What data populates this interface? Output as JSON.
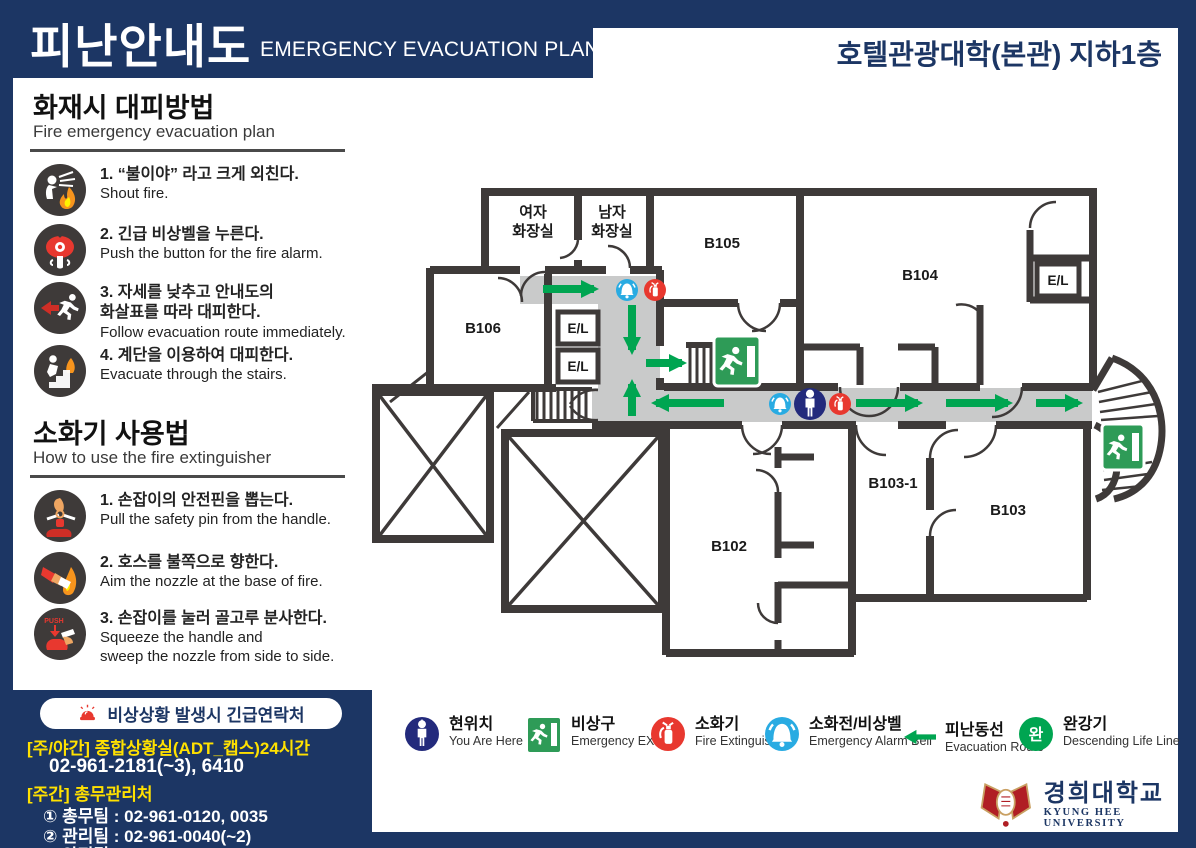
{
  "header": {
    "title_ko": "피난안내도",
    "title_en": "EMERGENCY EVACUATION PLAN",
    "building": "호텔관광대학(본관) 지하1층"
  },
  "sidebar": {
    "fire": {
      "title": "화재시 대피방법",
      "subtitle": "Fire emergency evacuation plan",
      "items": [
        {
          "icon": "shout-fire-icon",
          "ko": "1. “불이야” 라고 크게 외친다.",
          "en": "Shout fire."
        },
        {
          "icon": "alarm-button-icon",
          "ko": "2. 긴급 비상벨을 누른다.",
          "en": "Push the button for the fire alarm."
        },
        {
          "icon": "follow-route-icon",
          "ko": "3. 자세를 낮추고 안내도의\n화살표를 따라 대피한다.",
          "en": "Follow evacuation route immediately."
        },
        {
          "icon": "use-stairs-icon",
          "ko": "4. 계단을 이용하여 대피한다.",
          "en": "Evacuate through the stairs."
        }
      ]
    },
    "ext": {
      "title": "소화기 사용법",
      "subtitle": "How to use the fire extinguisher",
      "items": [
        {
          "icon": "pull-pin-icon",
          "ko": "1. 손잡이의 안전핀을 뽑는다.",
          "en": "Pull the safety pin from the handle."
        },
        {
          "icon": "aim-nozzle-icon",
          "ko": "2. 호스를 불쪽으로 향한다.",
          "en": "Aim the nozzle at the base of fire."
        },
        {
          "icon": "squeeze-icon",
          "ko": "3. 손잡이를 눌러 골고루 분사한다.",
          "en": "Squeeze the handle and\nsweep the nozzle from side to side."
        }
      ]
    }
  },
  "contact": {
    "icon": "siren-icon",
    "title": "비상상황 발생시 긴급연락처",
    "lines": [
      {
        "text": "[주/야간] 종합상황실(ADT_캡스)24시간",
        "style": "yellow"
      },
      {
        "text": "02-961-2181(~3), 6410",
        "style": "phone"
      },
      {
        "text": "[주간] 총무관리처",
        "style": "yellow"
      },
      {
        "text": "① 총무팀 : 02-961-0120, 0035",
        "style": "white"
      },
      {
        "text": "② 관리팀 : 02-961-0040(~2)",
        "style": "white"
      },
      {
        "text": "③ 안전팀 : 02-961-0119",
        "style": "white"
      }
    ]
  },
  "floorplan": {
    "labels": {
      "women_1": "여자",
      "women_2": "화장실",
      "men_1": "남자",
      "men_2": "화장실",
      "b105": "B105",
      "b104": "B104",
      "b106": "B106",
      "b102": "B102",
      "b103_1": "B103-1",
      "b103": "B103",
      "el": "E/L"
    }
  },
  "legend": {
    "badge": "완",
    "items": [
      {
        "icon": "you-are-here-icon",
        "ko": "현위치",
        "en": "You Are Here"
      },
      {
        "icon": "emergency-exit-icon",
        "ko": "비상구",
        "en": "Emergency EXIT"
      },
      {
        "icon": "fire-extinguisher-icon",
        "ko": "소화기",
        "en": "Fire Extinguisher"
      },
      {
        "icon": "alarm-bell-icon",
        "ko": "소화전/비상벨",
        "en": "Emergency Alarm Bell"
      },
      {
        "icon": "evacuation-route-icon",
        "ko": "피난동선",
        "en": "Evacuation Route"
      },
      {
        "icon": "descending-life-line-icon",
        "ko": "완강기",
        "en": "Descending Life Line"
      }
    ]
  },
  "footer": {
    "univ_ko": "경희대학교",
    "univ_en": "KYUNG HEE UNIVERSITY"
  },
  "colors": {
    "navy": "#1c3664",
    "wall": "#3e3a39",
    "corridor_grey": "#c9caca",
    "route_green": "#00a551",
    "exit_green": "#2e9b57",
    "red": "#e8382f",
    "bell_blue": "#29abe2",
    "marker_navy": "#232a7c",
    "yellow": "#ffe100"
  }
}
